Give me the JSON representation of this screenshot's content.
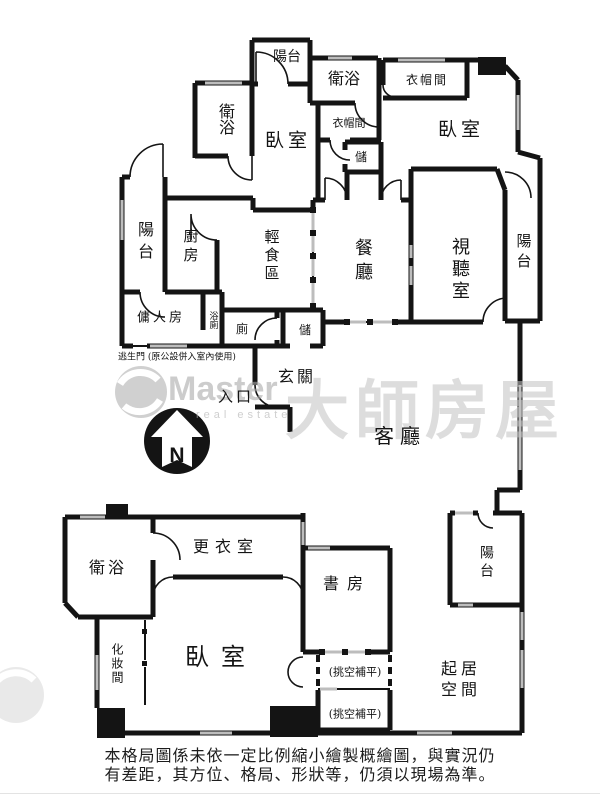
{
  "floorplan": {
    "rooms": {
      "balcony_top": "陽台",
      "bath_top_center": "衛浴",
      "cloakroom_top_right": "衣帽間",
      "bath_top_left": "衛浴",
      "bedroom_top_left": "臥室",
      "cloakroom_center": "衣帽間",
      "storage_top": "儲",
      "bedroom_top_right": "臥室",
      "balcony_left": "陽台",
      "kitchen": "廚房",
      "light_meal_area": "輕食區",
      "maid_room": "傭人房",
      "bath_toilet": "浴廁",
      "toilet": "廁",
      "storage_mid": "儲",
      "dining_room": "餐廳",
      "av_room": "視聽室",
      "balcony_right": "陽台",
      "foyer": "玄關",
      "entrance": "入口",
      "living_room": "客廳",
      "bath_bottom_left": "衛浴",
      "dressing_room": "更衣室",
      "study": "書房",
      "balcony_bottom_right": "陽台",
      "makeup_room": "化妝間",
      "bedroom_master": "臥室",
      "void_fill_upper": "(挑空補平)",
      "void_fill_lower": "(挑空補平)",
      "sitting_area_line1": "起居",
      "sitting_area_line2": "空間"
    },
    "notes": {
      "escape_door": "逃生門 (原公設併入室內使用)"
    },
    "compass": {
      "label": "N"
    },
    "watermark": {
      "brand": "Master",
      "sub": "real estate",
      "cjk": "大師房屋"
    },
    "disclaimer": {
      "line1": "本格局圖係未依一定比例縮小繪製概繪圖，與實況仍",
      "line2": "有差距，其方位、格局、形狀等，仍須以現場為準。"
    },
    "colors": {
      "wall": "#141414",
      "window": "#bdbdbd",
      "watermark": "#c3c3c3"
    }
  }
}
